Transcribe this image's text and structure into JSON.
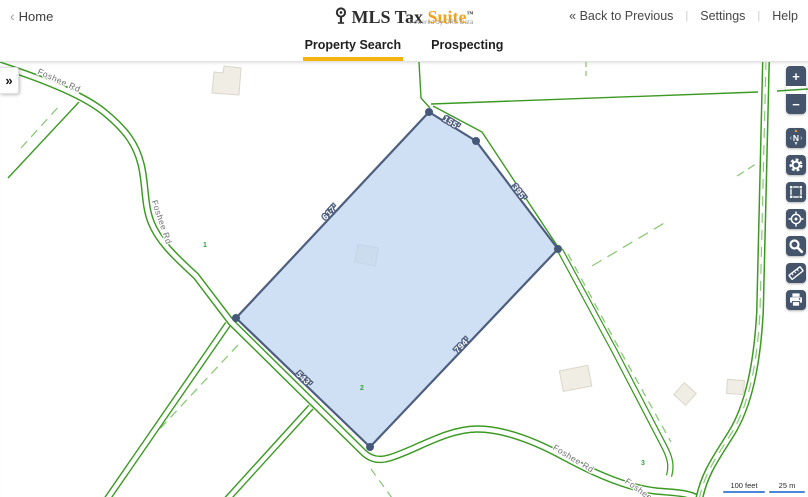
{
  "header": {
    "home_chevron": "‹",
    "home_label": "Home",
    "logo_brand": "MLS Tax",
    "logo_accent": "Suite",
    "logo_tm": "™",
    "logo_tagline": "Powered by CRS Data",
    "back_label": "« Back to Previous",
    "sep1": "|",
    "sep2": "|",
    "settings_label": "Settings",
    "help_label": "Help"
  },
  "tabs": {
    "property_search": "Property Search",
    "prospecting": "Prospecting"
  },
  "map": {
    "expander": "»",
    "edge_labels": {
      "e155": "155'",
      "e395": "395'",
      "e794": "794'",
      "e543": "543'",
      "e617": "617'"
    },
    "roads": {
      "foshee_top": "Foshee Rd",
      "foshee_mid": "Foshee Rd",
      "foshee_bottom": "Foshee Rd",
      "foshee_cut": "Foshee Rd"
    },
    "lots": {
      "n1": "1",
      "n2": "2",
      "n3": "3"
    },
    "scale": {
      "feet": "100 feet",
      "meters": "25 m"
    },
    "toolbar": {
      "zoom_in": "+",
      "zoom_out": "−",
      "compass_up": "▲",
      "compass_left": "‹",
      "compass_n": "N",
      "compass_right": "›",
      "compass_down": "▼",
      "icons": [
        "zoom-in-icon",
        "zoom-out-icon",
        "compass-icon",
        "gear-icon",
        "extent-icon",
        "locate-icon",
        "search-icon",
        "measure-icon",
        "print-icon"
      ]
    }
  },
  "colors": {
    "accent_underline": "#F5B311",
    "logo_accent": "#F0A41C",
    "parcel_fill": "#CEDFF4",
    "parcel_stroke": "#4D5E7E",
    "road_green": "#3B9A22",
    "dash_green": "#8CC979",
    "button_bg": "#44556B",
    "compass_arrow_orange": "#F2A33C",
    "scale_blue": "#4C86D9"
  }
}
